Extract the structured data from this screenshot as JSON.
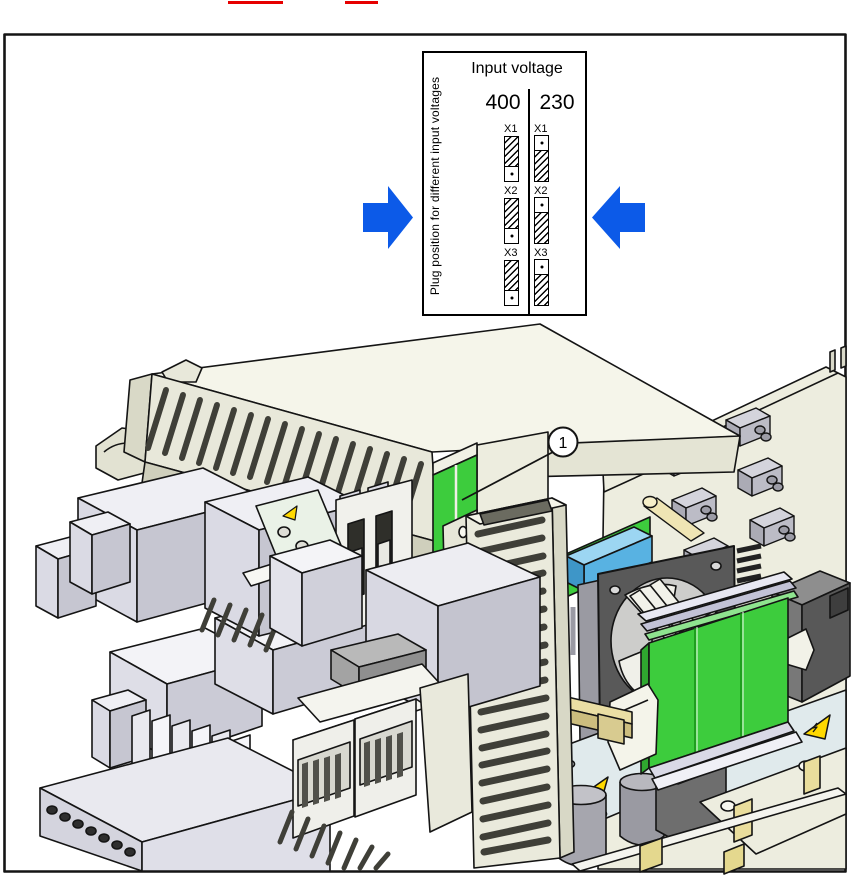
{
  "colors": {
    "highlight_green": "#3DCC3D",
    "arrow_blue": "#0C5AE8",
    "warning_yellow": "#FFD900",
    "top_red_marks": "#E60000"
  },
  "figure": {
    "panel": {
      "title": "Input voltage",
      "side_label": "Plug position for different input voltages",
      "columns": [
        {
          "label": "400"
        },
        {
          "label": "230"
        }
      ],
      "jumper_labels": [
        "X1",
        "X2",
        "X3"
      ]
    },
    "callout": {
      "number": "1"
    }
  }
}
